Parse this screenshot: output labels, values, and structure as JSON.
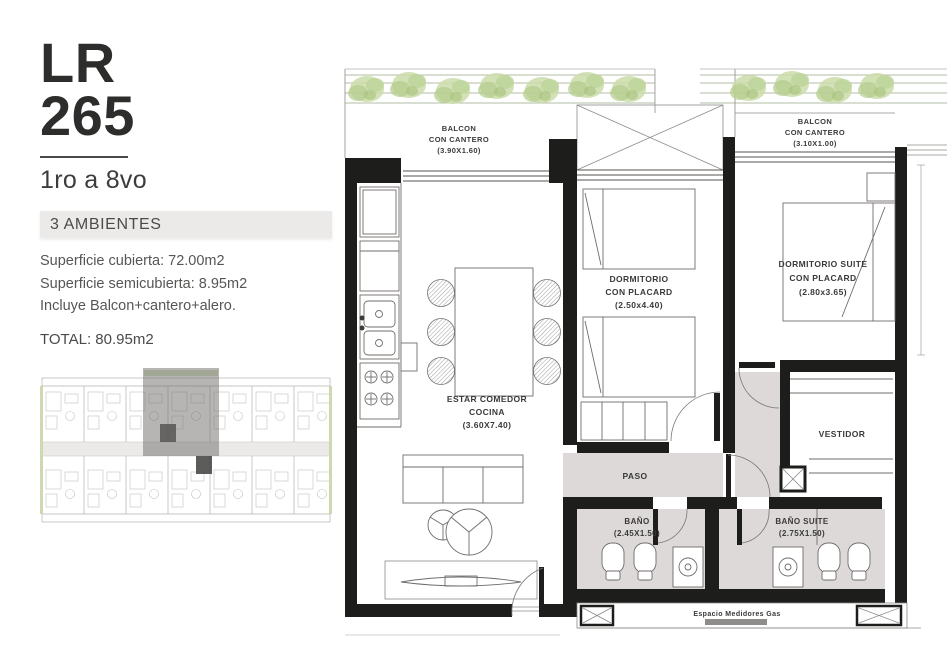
{
  "sidebar": {
    "unit": {
      "line1": "LR",
      "line2": "265"
    },
    "floors": "1ro a 8vo",
    "ambientes_badge": "3 AMBIENTES",
    "details": [
      "Superficie cubierta: 72.00m2",
      "Superficie semicubierta: 8.95m2",
      "Incluye Balcon+cantero+alero."
    ],
    "total": "TOTAL: 80.95m2"
  },
  "plan": {
    "balcony_left": {
      "l1": "BALCON",
      "l2": "CON CANTERO",
      "dim": "(3.90X1.60)"
    },
    "balcony_right": {
      "l1": "BALCON",
      "l2": "CON CANTERO",
      "dim": "(3.10X1.00)"
    },
    "living": {
      "l1": "ESTAR COMEDOR",
      "l2": "COCINA",
      "dim": "(3.60X7.40)"
    },
    "bedroom": {
      "l1": "DORMITORIO",
      "l2": "CON PLACARD",
      "dim": "(2.50x4.40)"
    },
    "suite": {
      "l1": "DORMITORIO SUITE",
      "l2": "CON PLACARD",
      "dim": "(2.80x3.65)"
    },
    "paso": "PASO",
    "vestidor": "VESTIDOR",
    "bath": {
      "l1": "BAÑO",
      "dim": "(2.45X1.50)"
    },
    "bath_suite": {
      "l1": "BAÑO SUITE",
      "dim": "(2.75X1.50)"
    },
    "meters": "Espacio Medidores Gas"
  },
  "colors": {
    "wall": "#1d1d1b",
    "floor_gray": "#dcd9d8",
    "planter_green": "#cbdcaa",
    "badge_bg": "#eceae9",
    "keyplan_highlight": "#6e6c6a"
  }
}
